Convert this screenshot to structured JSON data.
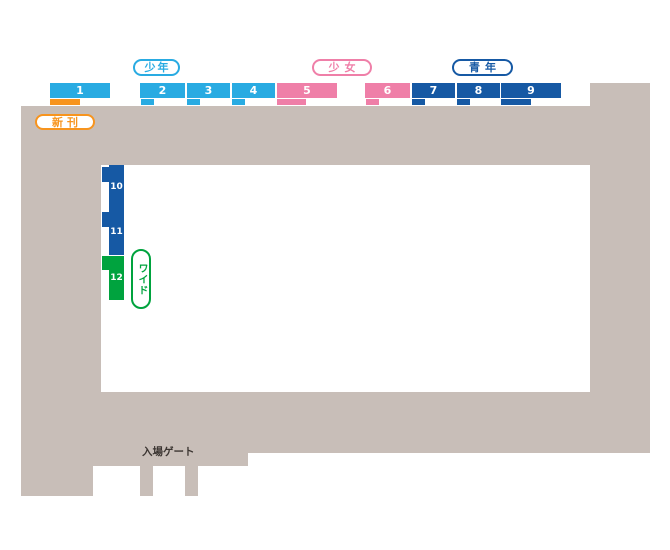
{
  "page": {
    "background": "#ffffff"
  },
  "colors": {
    "shonen": "#29abe2",
    "shojo": "#ef7fa8",
    "seinen": "#1659a4",
    "shinkan": "#f7941e",
    "wide": "#00a33e",
    "floor": "#c8beb8",
    "gate_text": "#3b3531",
    "shelf_number_text": "#ffffff"
  },
  "legend": {
    "shonen": "少年",
    "shojo": "少女",
    "seinen": "青年",
    "shinkan": "新刊",
    "wide": "ワイド"
  },
  "gate": {
    "label": "入場ゲート"
  },
  "shelves": {
    "top_row": [
      {
        "number": "1",
        "category": "shonen",
        "tab": "shinkan"
      },
      {
        "number": "2",
        "category": "shonen",
        "tab": "shonen"
      },
      {
        "number": "3",
        "category": "shonen",
        "tab": "shonen"
      },
      {
        "number": "4",
        "category": "shonen",
        "tab": "shonen"
      },
      {
        "number": "5",
        "category": "shojo",
        "tab": "shojo"
      },
      {
        "number": "6",
        "category": "shojo",
        "tab": "shojo"
      },
      {
        "number": "7",
        "category": "seinen",
        "tab": "seinen"
      },
      {
        "number": "8",
        "category": "seinen",
        "tab": "seinen"
      },
      {
        "number": "9",
        "category": "seinen",
        "tab": "seinen"
      }
    ],
    "left_column": [
      {
        "number": "10",
        "category": "seinen"
      },
      {
        "number": "11",
        "category": "seinen"
      },
      {
        "number": "12",
        "category": "wide"
      }
    ]
  }
}
